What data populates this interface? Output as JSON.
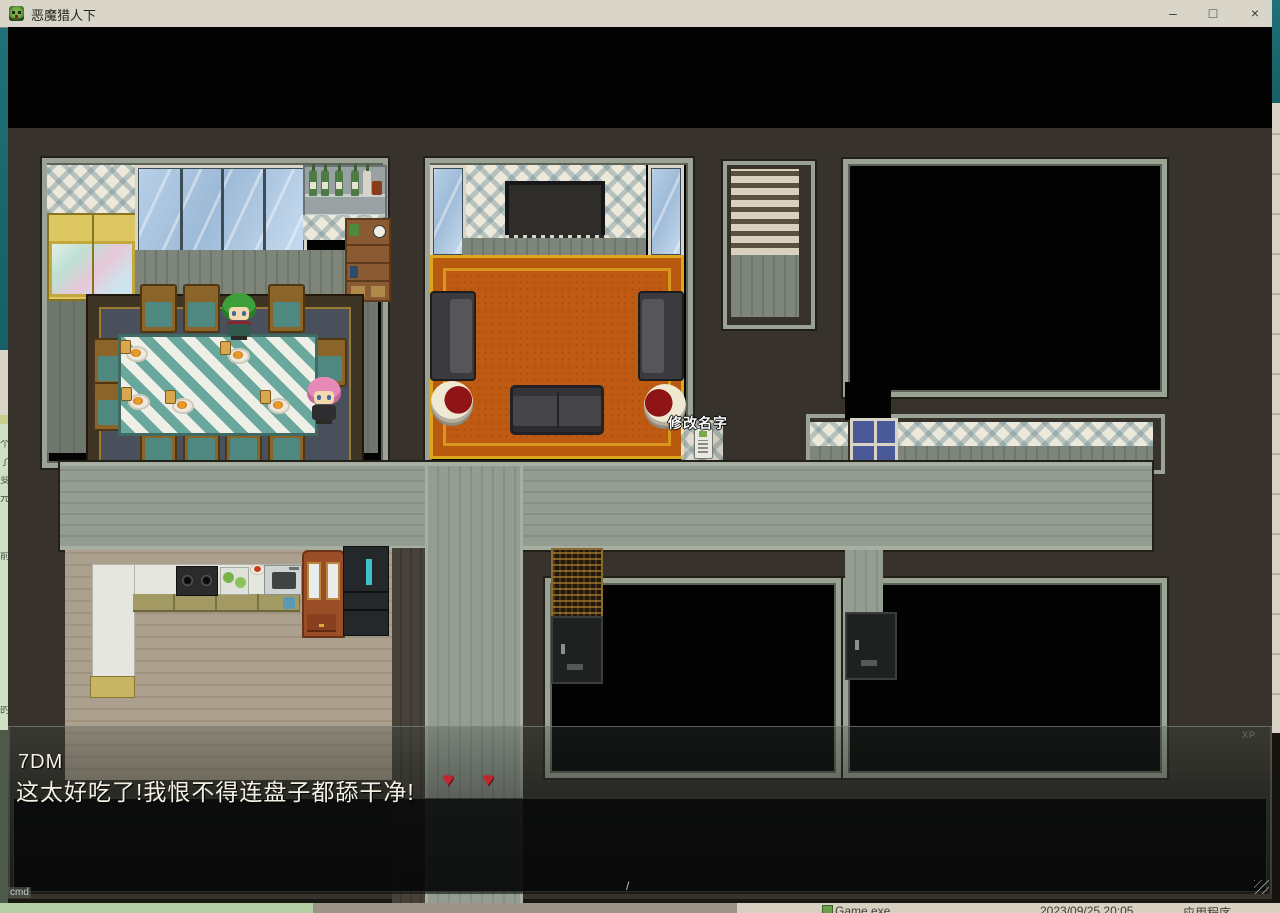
{
  "window": {
    "title": "恶魔猎人下",
    "controls": {
      "minimize": "–",
      "maximize": "□",
      "close": "×"
    }
  },
  "game": {
    "map_label": "修改名字",
    "dialog": {
      "speaker": "7DM",
      "message": "这太好吃了!我恨不得连盘子都舔干净!",
      "heart_icon": "♥",
      "heart_count": 2,
      "watermark": "XP"
    },
    "overlay": {
      "cmd_label": "cmd",
      "slash": "/"
    }
  },
  "background": {
    "left_edge_chars": [
      "个",
      "了",
      "变",
      "元",
      "前",
      "的"
    ],
    "file_row": {
      "file_name": "Game.exe",
      "modified": "2023/09/25 20:05",
      "type": "应用程序"
    },
    "colors": {
      "desktop_teal": "#1d6b72",
      "titlebar": "#d9d5c9",
      "taskbar_green": "#b4cfa5",
      "taskbar_taupe": "#9d9488",
      "explorer_tan": "#d8d0c1",
      "living_carpet": "#bf5a12",
      "heart_red": "#c1272d"
    }
  }
}
